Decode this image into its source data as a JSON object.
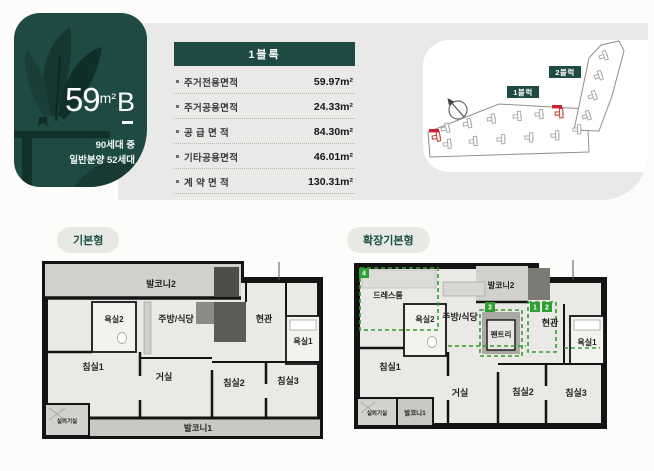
{
  "unit_card": {
    "size_number": "59",
    "size_unit": "m²",
    "type_letter": "B",
    "supply_line1": "90세대 중",
    "supply_line2": "일반분양 52세대"
  },
  "area_table": {
    "header": "1블록",
    "rows": [
      {
        "label": "주거전용면적",
        "value": "59.97m²"
      },
      {
        "label": "주거공용면적",
        "value": "24.33m²"
      },
      {
        "label": "공 급 면 적",
        "value": "84.30m²"
      },
      {
        "label": "기타공용면적",
        "value": "46.01m²"
      },
      {
        "label": "계 약 면 적",
        "value": "130.31m²"
      }
    ]
  },
  "site_plan": {
    "block1_badge": "1블럭",
    "block2_badge": "2블럭"
  },
  "floor_plans": {
    "basic": {
      "title": "기본형",
      "rooms": {
        "balcony2": "발코니2",
        "bath2": "욕실2",
        "kitchen_dining": "주방/식당",
        "entrance": "현관",
        "bath1": "욕실1",
        "bedroom1": "침실1",
        "living": "거실",
        "bedroom2": "침실2",
        "bedroom3": "침실3",
        "ac_room": "실외기실",
        "balcony1": "발코니1"
      }
    },
    "extended": {
      "title": "확장기본형",
      "rooms": {
        "dressroom": "드레스룸",
        "bath2": "욕실2",
        "kitchen_dining": "주방/식당",
        "balcony2": "발코니2",
        "pantry": "팬트리",
        "entrance": "현관",
        "bath1": "욕실1",
        "bedroom1": "침실1",
        "living": "거실",
        "bedroom2": "침실2",
        "bedroom3": "침실3",
        "ac_room": "실외기실",
        "balcony1": "발코니1"
      },
      "badges": {
        "b1": "1",
        "b2": "2",
        "b3": "3",
        "b4": "4"
      }
    }
  },
  "colors": {
    "brand_green": "#1e4a43",
    "accent_green": "#2f9e33",
    "marker_red": "#cc2233",
    "panel_gray": "#e9e9e7"
  }
}
